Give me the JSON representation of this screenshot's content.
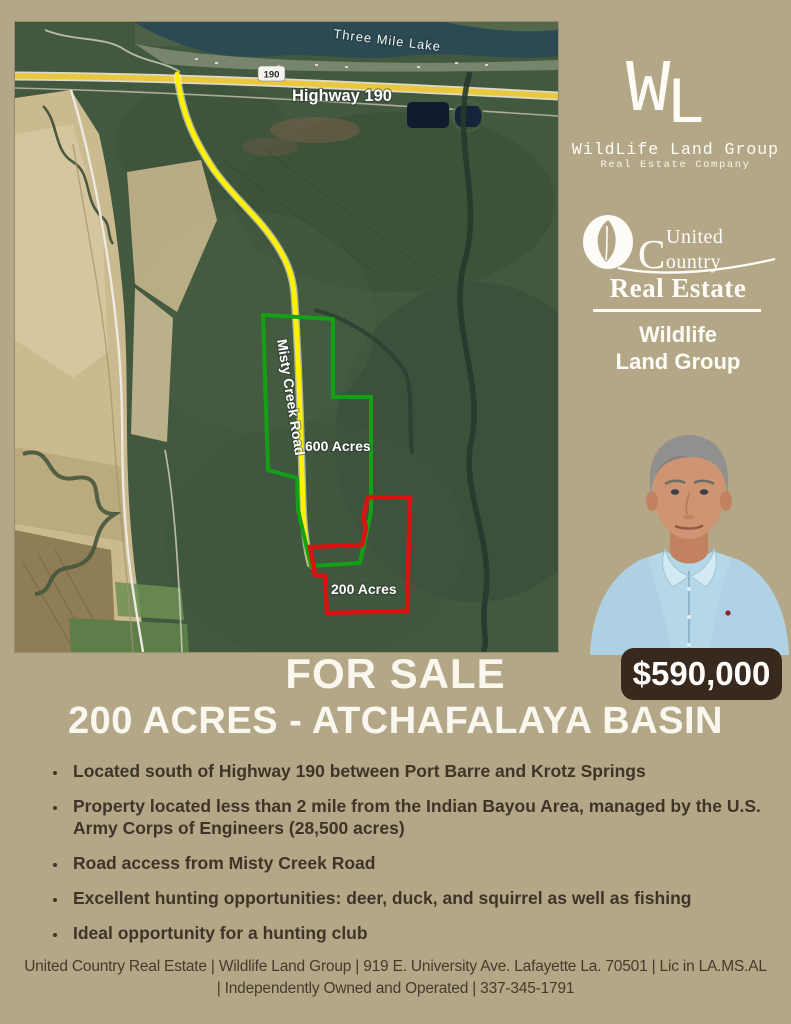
{
  "page": {
    "background": "#b3a787"
  },
  "map": {
    "labels": {
      "lake": "Three Mile Lake",
      "route_shield": "190",
      "highway": "Highway 190",
      "road": "Misty Creek Road",
      "parcel_green": "600 Acres",
      "parcel_red": "200 Acres"
    },
    "colors": {
      "parcel_green_outline": "#14a014",
      "parcel_red_outline": "#dc1212",
      "route_highlight": "#fef200",
      "highway_yellow": "#e9c83e"
    }
  },
  "branding": {
    "wl_logo": {
      "monogram_w": "W",
      "monogram_l": "L",
      "name": "WildLife Land Group",
      "tagline": "Real Estate Company"
    },
    "uc_logo": {
      "united": "United",
      "country": "Country",
      "real_estate": "Real Estate",
      "division_line1": "Wildlife",
      "division_line2": "Land Group"
    }
  },
  "sale": {
    "title": "FOR SALE",
    "price": "$590,000",
    "subtitle": "200 ACRES - ATCHAFALAYA BASIN",
    "price_badge_color": "#38291f"
  },
  "bullets": [
    "Located south of Highway 190 between Port Barre and Krotz Springs",
    "Property located less than 2 mile from the Indian Bayou Area, managed by the U.S. Army Corps of Engineers (28,500 acres)",
    "Road access from Misty Creek Road",
    "Excellent hunting opportunities: deer, duck, and squirrel as well as fishing",
    "Ideal opportunity for a hunting club"
  ],
  "footer": {
    "line1": "United Country Real Estate | Wildlife Land Group | 919 E. University Ave. Lafayette La. 70501 | Lic in LA.MS.AL",
    "line2": "| Independently Owned and Operated | 337-345-1791"
  }
}
